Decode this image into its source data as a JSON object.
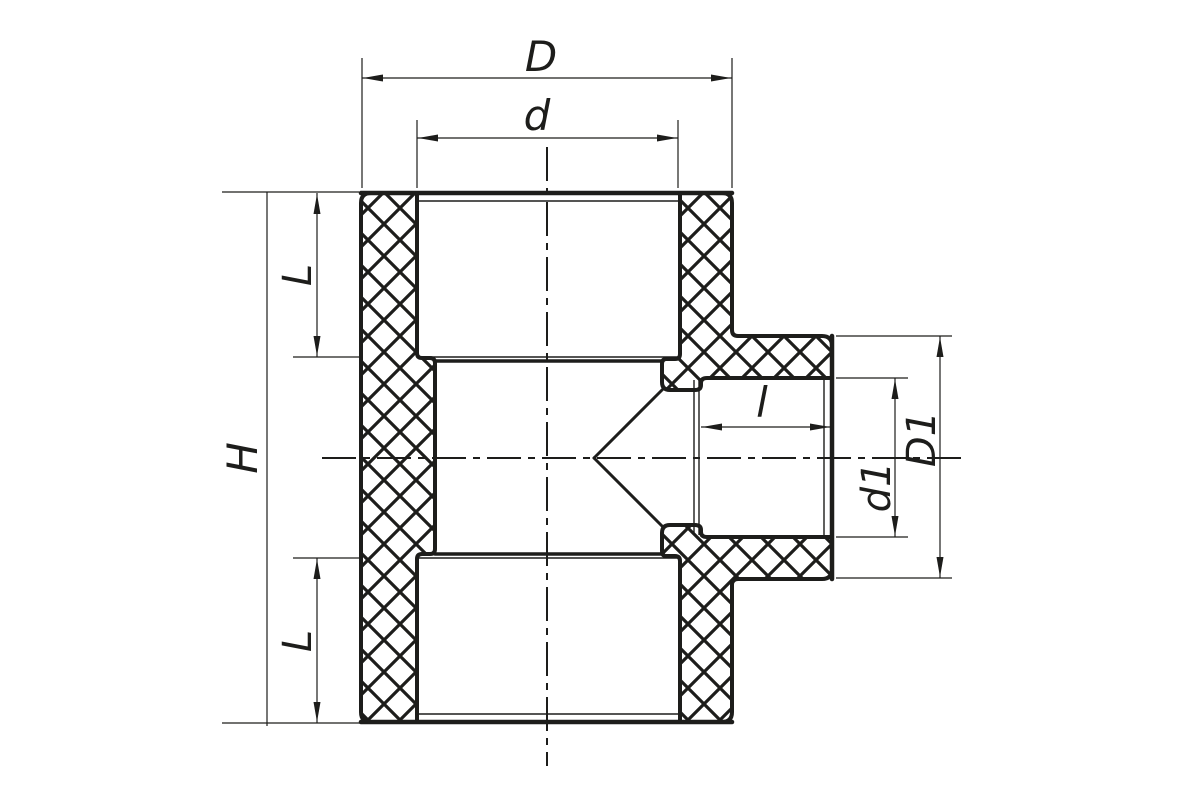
{
  "drawing": {
    "background": "#ffffff",
    "line_color": "#1d1d1b",
    "labels": {
      "overall_width": "D",
      "socket_bore": "d",
      "overall_height": "H",
      "socket_depth_top": "L",
      "socket_depth_bottom": "L",
      "branch_socket_depth": "l",
      "branch_bore": "d1",
      "branch_outer_diameter": "D1"
    }
  }
}
